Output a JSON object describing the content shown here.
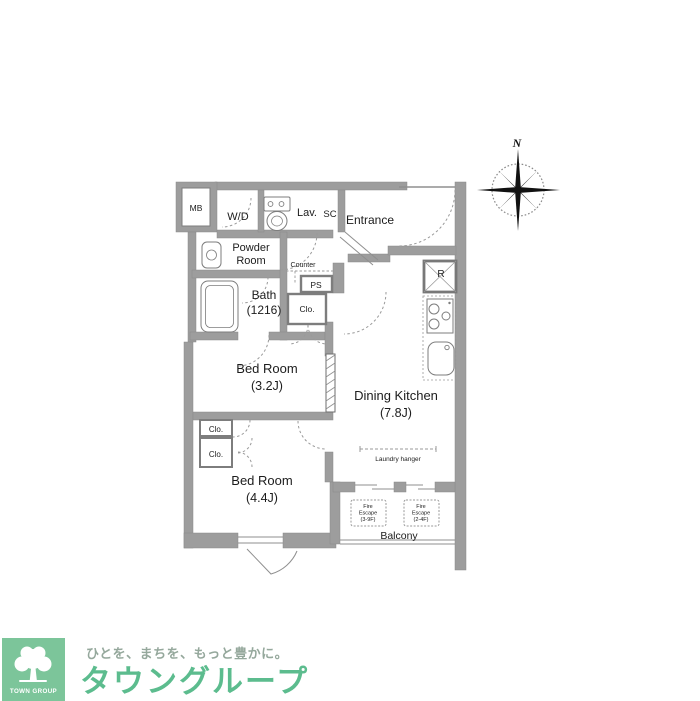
{
  "floorplan": {
    "compass": {
      "north": "N"
    },
    "labels": {
      "mb": "MB",
      "wd": "W/D",
      "lav": "Lav.",
      "sc": "SC",
      "entrance": "Entrance",
      "powder_1": "Powder",
      "powder_2": "Room",
      "counter": "Counter",
      "ps": "PS",
      "bath_1": "Bath",
      "bath_2": "(1216)",
      "closet_bath": "Clo.",
      "closet_upper": "Clo.",
      "closet_lower": "Clo.",
      "bedroom1_1": "Bed Room",
      "bedroom1_2": "(3.2J)",
      "bedroom2_1": "Bed Room",
      "bedroom2_2": "(4.4J)",
      "dining_1": "Dining Kitchen",
      "dining_2": "(7.8J)",
      "laundry_hanger": "Laundry hanger",
      "refrigerator": "R",
      "balcony": "Balcony",
      "fire_escape_left_1": "Fire",
      "fire_escape_left_2": "Escape",
      "fire_escape_left_3": "(3-9F)",
      "fire_escape_right_1": "Fire",
      "fire_escape_right_2": "Escape",
      "fire_escape_right_3": "(2-4F)"
    },
    "colors": {
      "wall": "#9d9d9d",
      "fixture_line": "#7d7d7d",
      "text": "#1c1c1c"
    }
  },
  "footer": {
    "logo_square_text": "TOWN GROUP",
    "tagline": "ひとを、まちを、もっと豊かに。",
    "company": "タウングループ",
    "colors": {
      "square": "#7cc59a",
      "company_text": "#5cbc8e",
      "tagline_text": "#95a89c"
    }
  }
}
